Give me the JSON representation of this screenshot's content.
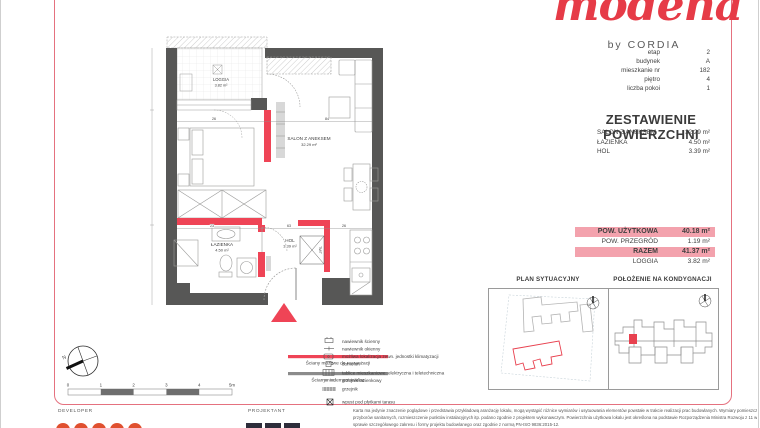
{
  "brand": {
    "logo": "modena",
    "byline": "by CORDIA"
  },
  "unit_info": {
    "rows": [
      {
        "label": "etap",
        "value": "2"
      },
      {
        "label": "budynek",
        "value": "A"
      },
      {
        "label": "mieszkanie nr",
        "value": "182"
      },
      {
        "label": "piętro",
        "value": "4"
      },
      {
        "label": "liczba pokoi",
        "value": "1"
      }
    ]
  },
  "area_table": {
    "title": "ZESTAWIENIE POWIERZCHNI",
    "rooms": [
      {
        "label": "SALON Z ANEKSEM",
        "value": "32.29 m²"
      },
      {
        "label": "ŁAZIENKA",
        "value": "4.50 m²"
      },
      {
        "label": "HOL",
        "value": "3.39 m²"
      }
    ],
    "summary": [
      {
        "label": "POW. UŻYTKOWA",
        "value": "40.18 m²"
      },
      {
        "label": "POW. PRZEGRÓD",
        "value": "1.19 m²"
      },
      {
        "label": "RAZEM",
        "value": "41.37 m²"
      },
      {
        "label": "LOGGIA",
        "value": "3.82 m²"
      }
    ]
  },
  "floorplan": {
    "loggia": {
      "name": "LOGGIA",
      "area": "3.82 m²"
    },
    "salon": {
      "name": "SALON Z ANEKSEM",
      "area": "32.29 m²"
    },
    "bathroom": {
      "name": "ŁAZIENKA",
      "area": "4.50 m²"
    },
    "hall": {
      "name": "HOL",
      "area": "3.39 m²"
    },
    "shaft_label": "TM/T",
    "compass_label": "N",
    "dims": {
      "loggia_door": "26",
      "salon_width": "84",
      "bath": "23",
      "hall": "63",
      "kitchen": "26"
    }
  },
  "legend": {
    "rearrangeable": "Ściany możliwe do rearanżacji",
    "fixed": "Ściany niedemontowalne",
    "items": [
      "nawiewnik ścienny",
      "nawiewnik okienny",
      "możliwa lokalizacja zewn. jednostki klimatyzacji",
      "domofon",
      "tablice mieszkaniowe: elektryczna i teletechniczna",
      "grzejnik łazienkowy",
      "grzejnik",
      "wpust pod płytkami tarasu"
    ],
    "scale": [
      "0",
      "1",
      "2",
      "3",
      "4",
      "5m"
    ]
  },
  "panels": {
    "site_title": "PLAN SYTUACYJNY",
    "floor_title": "POŁOŻENIE NA KONDYGNACJI"
  },
  "footer": {
    "developer_label": "DEVELOPER",
    "designer_label": "PROJEKTANT",
    "disclaimer": [
      "Karta ma jedynie znaczenie poglądowe i przedstawia przykładową aranżację lokalu, mogą wystąpić różnice wymiarów i usytuowania elementów powstałe w trakcie realizacji prac budowlanych. Wymiary pomieszczeń, lokalizację",
      "przyborów sanitarnych, rozmieszczenie punktów instalacyjnych itp. podano zgodnie z projektem wykonawczym. Powierzchnia użytkowa lokalu jest określona na podstawie Rozporządzenia Ministra Rozwoju z 11 września 2020r. w",
      "sprawie szczegółowego zakresu i formy projektu budowlanego oraz zgodnie z normą PN-ISO 9836:2015-12."
    ]
  },
  "colors": {
    "accent": "#e8414f",
    "wall": "#575756",
    "highlight": "#f3a2ad",
    "frame": "#e5717f"
  }
}
